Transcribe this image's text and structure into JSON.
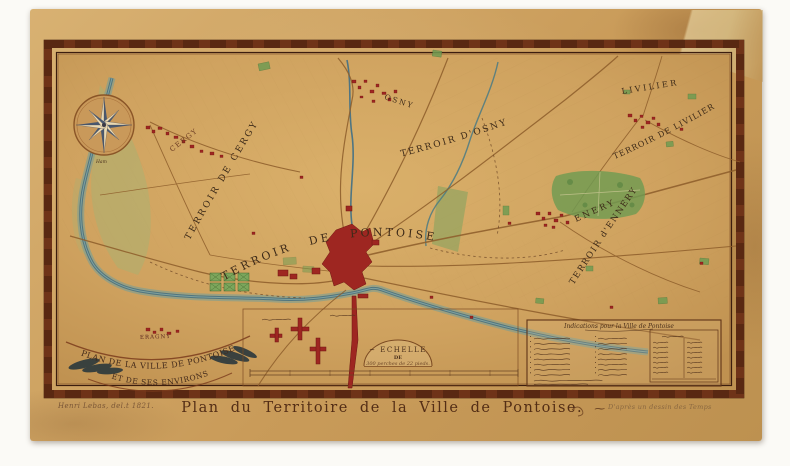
{
  "artwork": {
    "main_title": "Plan du Territoire de la Ville de Pontoise.",
    "title_flourish": "⁓",
    "signature": "Henri Lebas, del.t 1821.",
    "attribution": "D'après un dessin des Temps"
  },
  "cartouche": {
    "line1": "PLAN DE LA VILLE DE PONTOISE",
    "line2": "ET DE SES ENVIRONS"
  },
  "scale": {
    "label": "~ ECHELLE",
    "preposition": "DE",
    "measure": "300 perches de 22 pieds."
  },
  "legend": {
    "header": "Indications pour la Ville de Pontoise"
  },
  "labels": {
    "terroir_cergy": "TERROIR DE CERGY",
    "terroir_pontoise": "TERROIR DE PONTOISE",
    "terroir_osny": "TERROIR D'OSNY",
    "terroir_livilliers": "TERROIR DE LIVILIER",
    "terroir_ennery": "TERROIR d'ENNERY",
    "village_cergy": "CERGY",
    "village_osny": "OSNY",
    "village_livillier": "LIVILIER",
    "village_enery": "ENERY",
    "village_eragny": "ERAGNY",
    "hamlet_ham": "Ham"
  },
  "colors": {
    "paper": "#cfa15e",
    "frame_band": "#6f3318",
    "river": "#4e7f88",
    "town_red": "#9e2621",
    "woods_green": "#6f9b52",
    "ink": "#3d2a18"
  }
}
